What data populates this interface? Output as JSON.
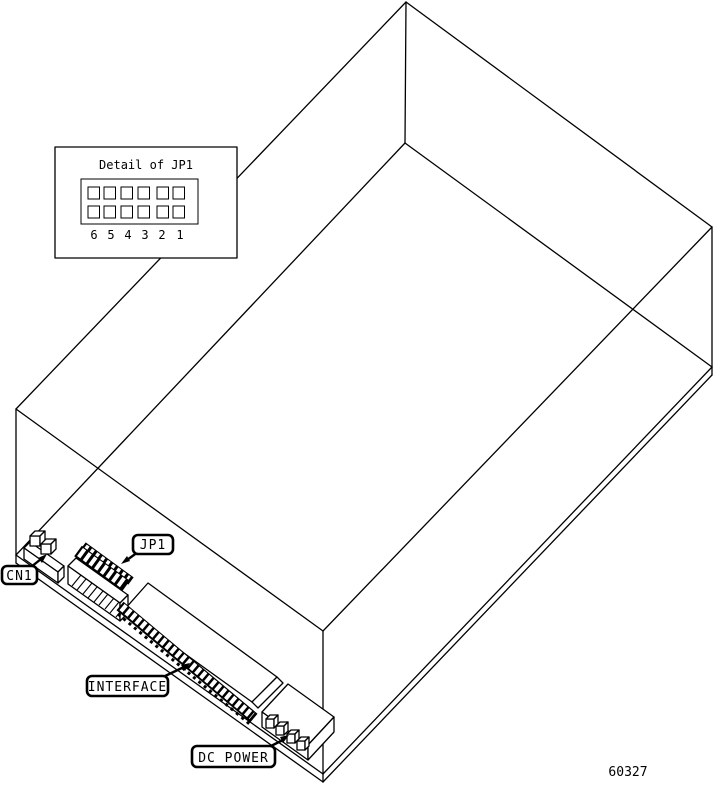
{
  "figure": {
    "drawing_number": "60327",
    "background_color": "#ffffff",
    "line_color": "#000000"
  },
  "detail_inset": {
    "title": "Detail of JP1",
    "pins": [
      "6",
      "5",
      "4",
      "3",
      "2",
      "1"
    ]
  },
  "callouts": {
    "cn1": {
      "label": "CN1"
    },
    "jp1": {
      "label": "JP1"
    },
    "interface": {
      "label": "INTERFACE"
    },
    "dc_power": {
      "label": "DC POWER"
    }
  }
}
